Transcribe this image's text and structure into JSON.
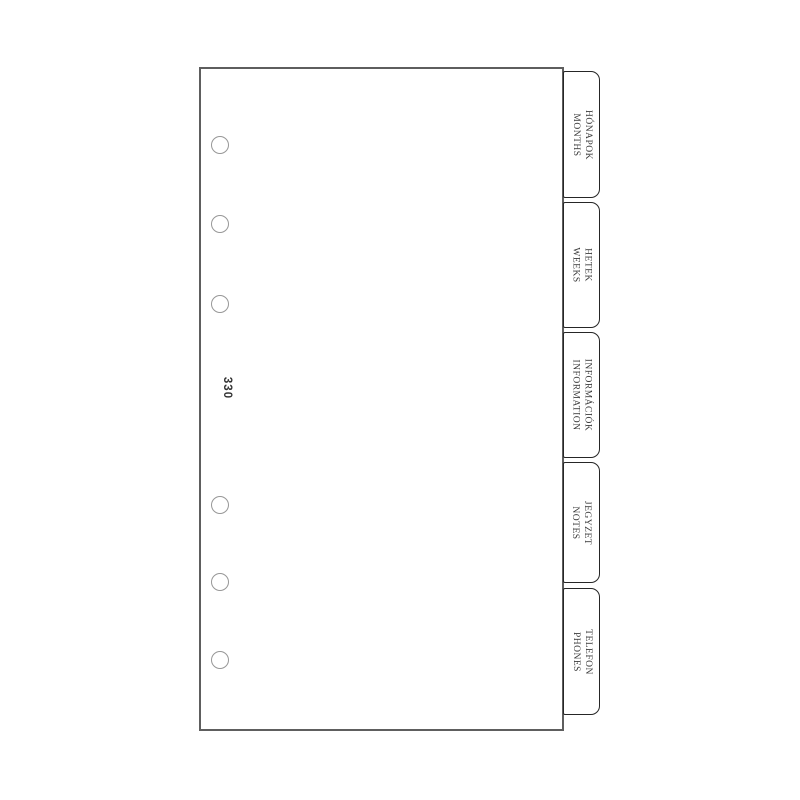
{
  "product": {
    "item_code": "330",
    "hole_count": 6,
    "tabs": [
      {
        "label_hu": "HÓNAPOK",
        "label_en": "MONTHS"
      },
      {
        "label_hu": "HETEK",
        "label_en": "WEEKS"
      },
      {
        "label_hu": "INFORMÁCIÓK",
        "label_en": "INFORMATION"
      },
      {
        "label_hu": "JEGYZET",
        "label_en": "NOTES"
      },
      {
        "label_hu": "TELEFON",
        "label_en": "PHONES"
      }
    ]
  },
  "colors": {
    "background": "#ffffff",
    "page_fill": "#ffffff",
    "page_border": "#5e5e5e",
    "tab_border": "#262626",
    "tab_text": "#3b3b3b",
    "hole_border": "#979797",
    "code_text": "#333333"
  }
}
